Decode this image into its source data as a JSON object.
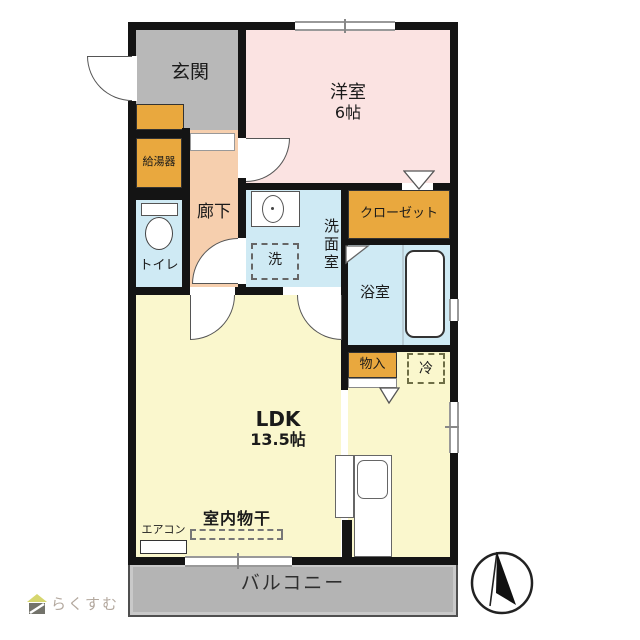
{
  "floorplan": {
    "rooms": {
      "genkan": {
        "label": "玄関"
      },
      "youshitsu": {
        "label": "洋室",
        "size": "6帖"
      },
      "rouka": {
        "label": "廊下"
      },
      "toilet": {
        "label": "トイレ"
      },
      "senmen": {
        "label": "洗面室"
      },
      "washer": {
        "label": "洗"
      },
      "closet": {
        "label": "クローゼット"
      },
      "bath": {
        "label": "浴室"
      },
      "monoire": {
        "label": "物入"
      },
      "fridge": {
        "label": "冷"
      },
      "ldk": {
        "label": "LDK",
        "size": "13.5帖"
      },
      "kyutouki": {
        "label": "給湯器"
      },
      "aircon": {
        "label": "エアコン"
      },
      "drying": {
        "label": "室内物干"
      },
      "balcony": {
        "label": "バルコニー"
      }
    },
    "colors": {
      "wall": "#141414",
      "genkan_gray": "#b8b8b8",
      "youshitsu_pink": "#fbe3e2",
      "rouka_peach": "#f6cfae",
      "wet_area_blue": "#cfeaf4",
      "storage_orange": "#e9a83e",
      "ldk_yellow": "#faf7cd",
      "balcony_gray": "#b4b4b4"
    }
  },
  "branding": {
    "logo_text": "らくすむ"
  }
}
